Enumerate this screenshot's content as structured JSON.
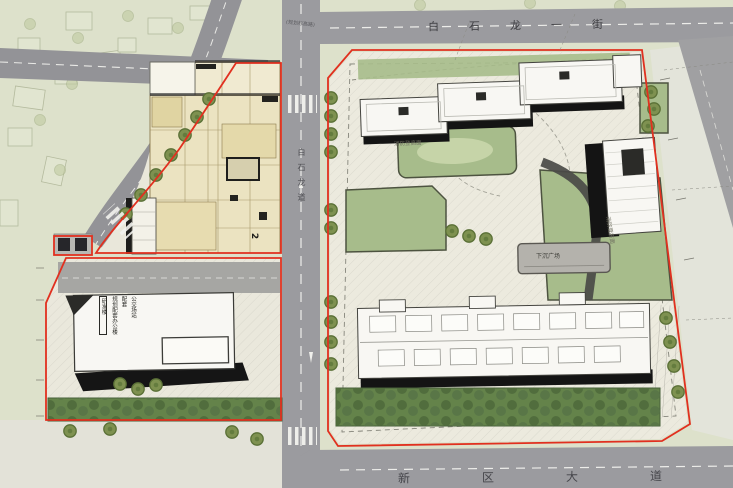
{
  "plan": {
    "streets": {
      "top": "白石龙一街",
      "bottom": "新区大道",
      "vertical": "白石龙道",
      "planned_note": "(规划标高路)"
    },
    "labels": {
      "sunken_plaza": "下沉广场",
      "fire_lane_top": "消防登高面",
      "fire_lane_right": "消防登高面",
      "block_marker": "2",
      "rd_building_col1": "研发楼",
      "rd_building_col2": "规划配套办公楼",
      "rd_building_col3": "配套",
      "rd_building_col4": "公交场站"
    },
    "colors": {
      "boundary_red": "#e1301f",
      "road_gray": "#9b9b9f",
      "lawn_green": "#a7bc8b",
      "tree_olive": "#7e9150",
      "building_white": "#f8f7f3",
      "shadow_black": "#161616",
      "podium_tan": "#ebe3c1",
      "context_green": "#dde1cb"
    }
  }
}
